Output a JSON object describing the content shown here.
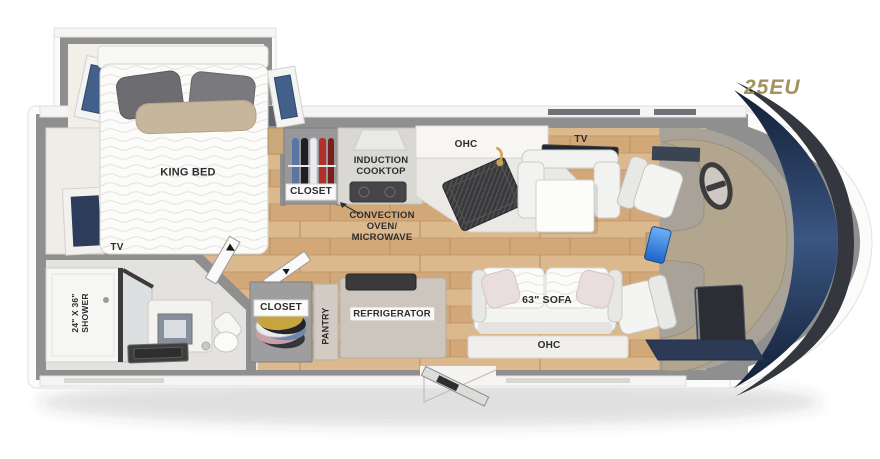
{
  "plan": {
    "model": "25EU",
    "kind": "motorhome-floorplan",
    "labels": {
      "king_bed": "KING BED",
      "closet_top": "CLOSET",
      "induction_cooktop": "INDUCTION\nCOOKTOP",
      "ohc_kitchen": "OHC",
      "convection_oven": "CONVECTION\nOVEN/\nMICROWAVE",
      "tv_dinette": "TV",
      "tv_bedroom": "TV",
      "shower": "24\" X 36\"\nSHOWER",
      "closet_bottom": "CLOSET",
      "pantry": "PANTRY",
      "refrigerator": "REFRIGERATOR",
      "sofa": "63\" SOFA",
      "ohc_sofa": "OHC"
    },
    "colors": {
      "model_accent": "#A3925E",
      "wall_gray": "#8F8F8F",
      "wood_floor": "#D4AE7E",
      "window_blue": "#42608A",
      "windshield_navy": "#1C2B4A",
      "label_text": "#2D2D2D",
      "dash_tan": "#B3A68E"
    }
  }
}
